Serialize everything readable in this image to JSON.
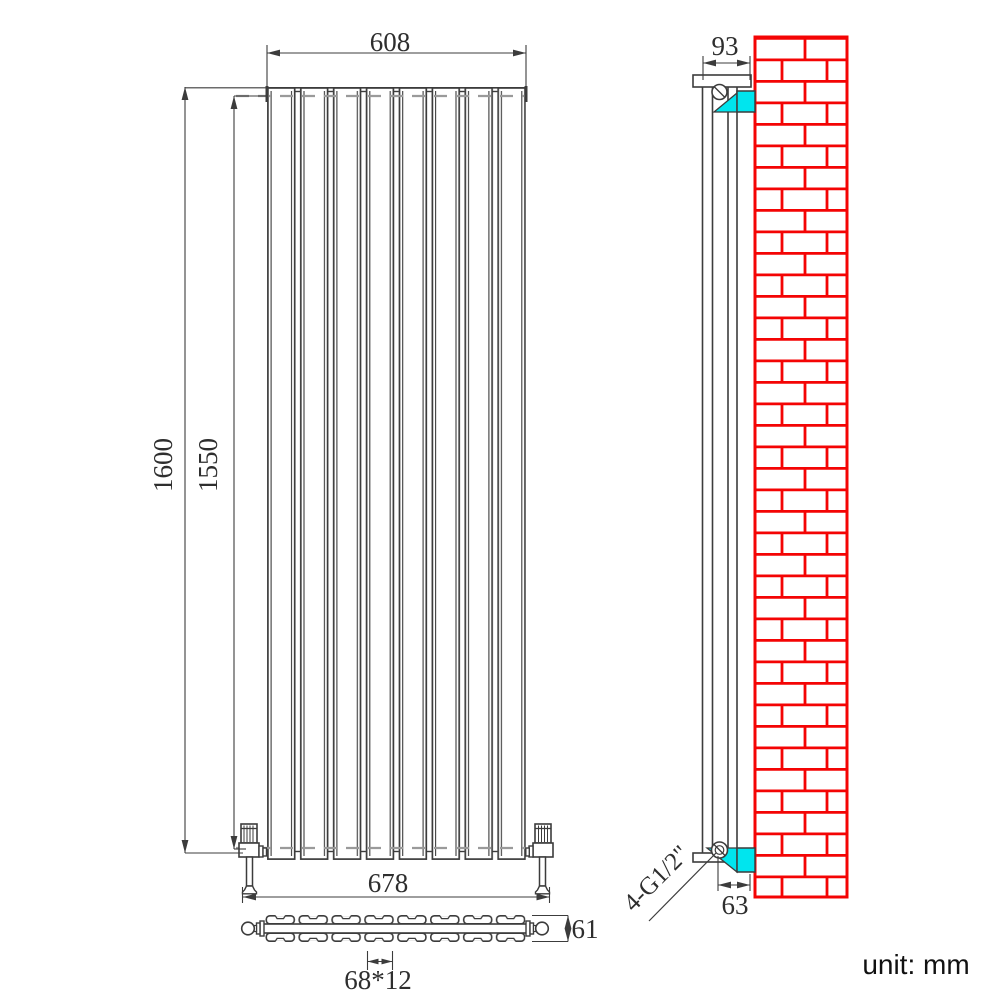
{
  "drawing": {
    "unit_note": "unit: mm",
    "front_view": {
      "width_label": "608",
      "total_height_label": "1600",
      "inner_height_label": "1550",
      "valve_span_label": "678"
    },
    "top_view": {
      "panel_section_label": "68*12",
      "depth_label": "61"
    },
    "side_view": {
      "depth_label": "93",
      "wall_offset_label": "63",
      "connection_label": "4-G1/2\""
    },
    "colors": {
      "line": "#3c3c3c",
      "dashed": "#9a9a9a",
      "brick_red": "#f40404",
      "bracket_cyan": "#00e5ee"
    }
  }
}
